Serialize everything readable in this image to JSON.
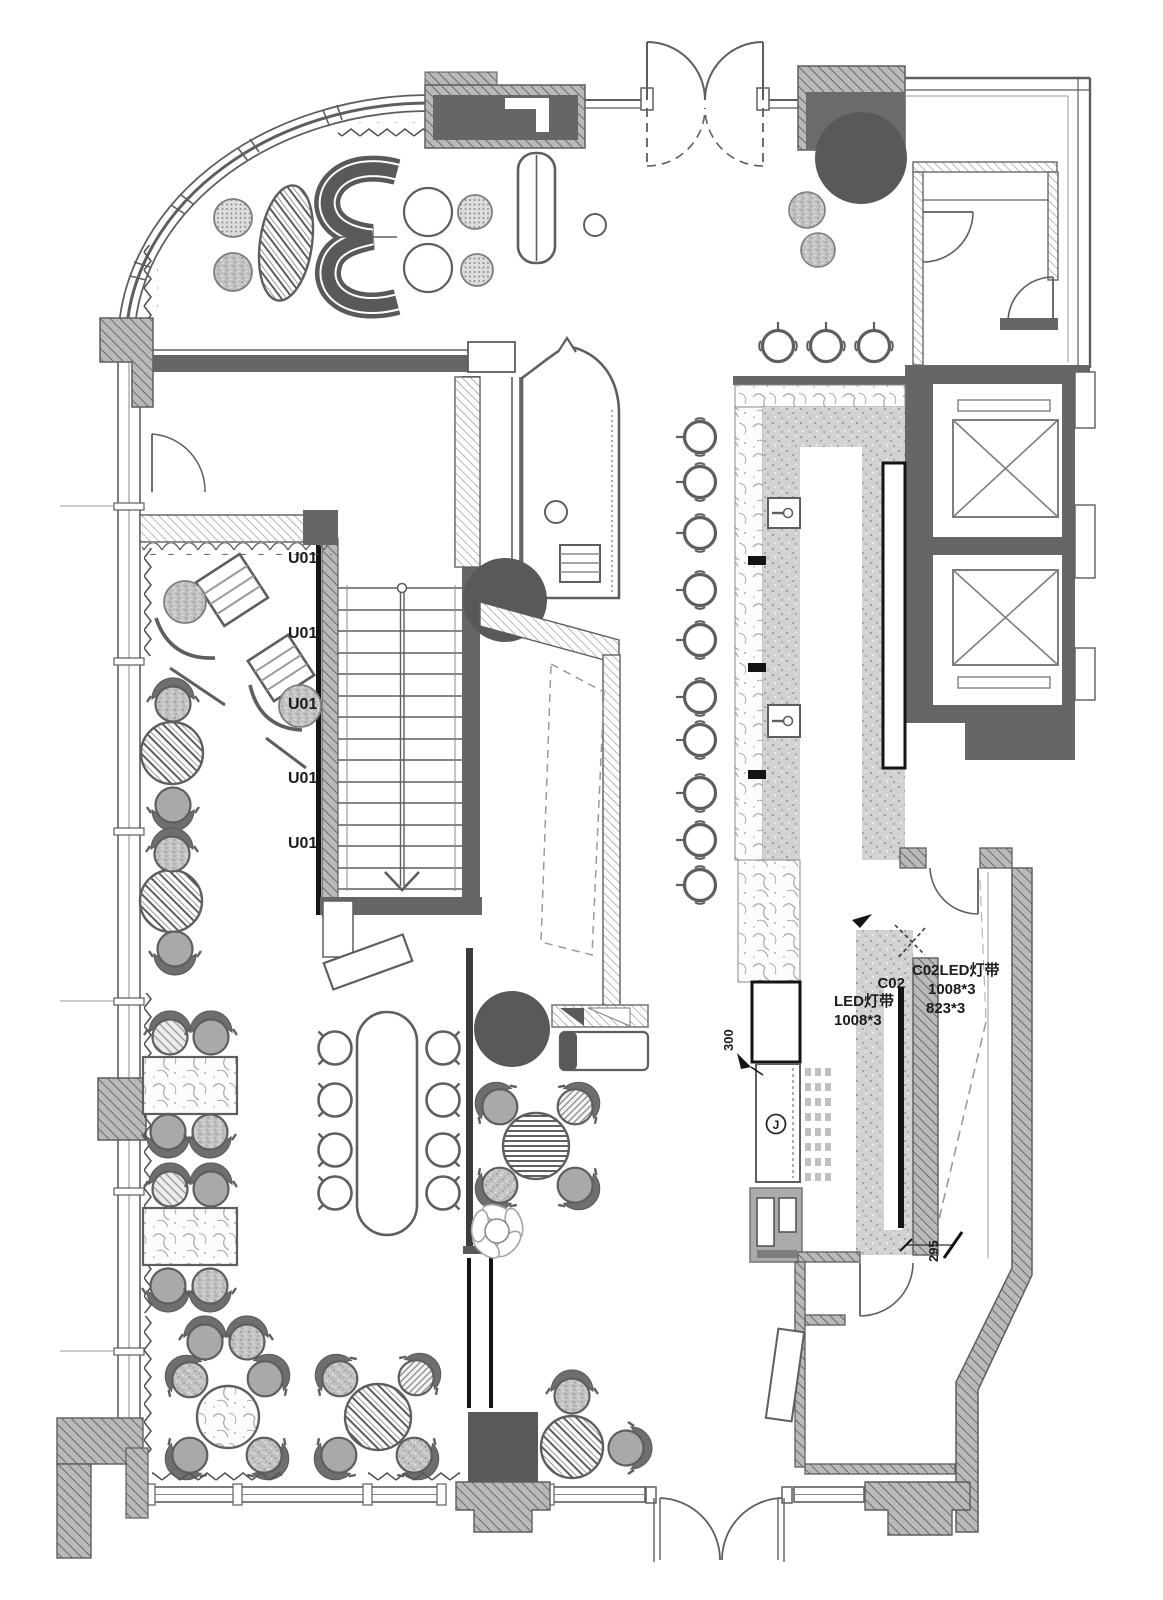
{
  "labels": {
    "unit": "U01",
    "equipment_circle": "J"
  },
  "annotations": {
    "led_left_code": "C02",
    "led_left_name": "LED灯带",
    "led_left_size": "1008*3",
    "led_right_name": "C02LED灯带",
    "led_right_size1": "1008*3",
    "led_right_size2": "823*3"
  },
  "dimensions": {
    "bar_counter_end": "300",
    "kitchen_pass": "295"
  },
  "colors": {
    "wall_dark": "#666666",
    "column_fill": "#595959",
    "line": "#5e5e5e",
    "hatch_light": "#9a9a9a",
    "counter_stipple": "#d6d6d6",
    "chair_gray": "#a9a9a9",
    "paper": "#ffffff"
  }
}
